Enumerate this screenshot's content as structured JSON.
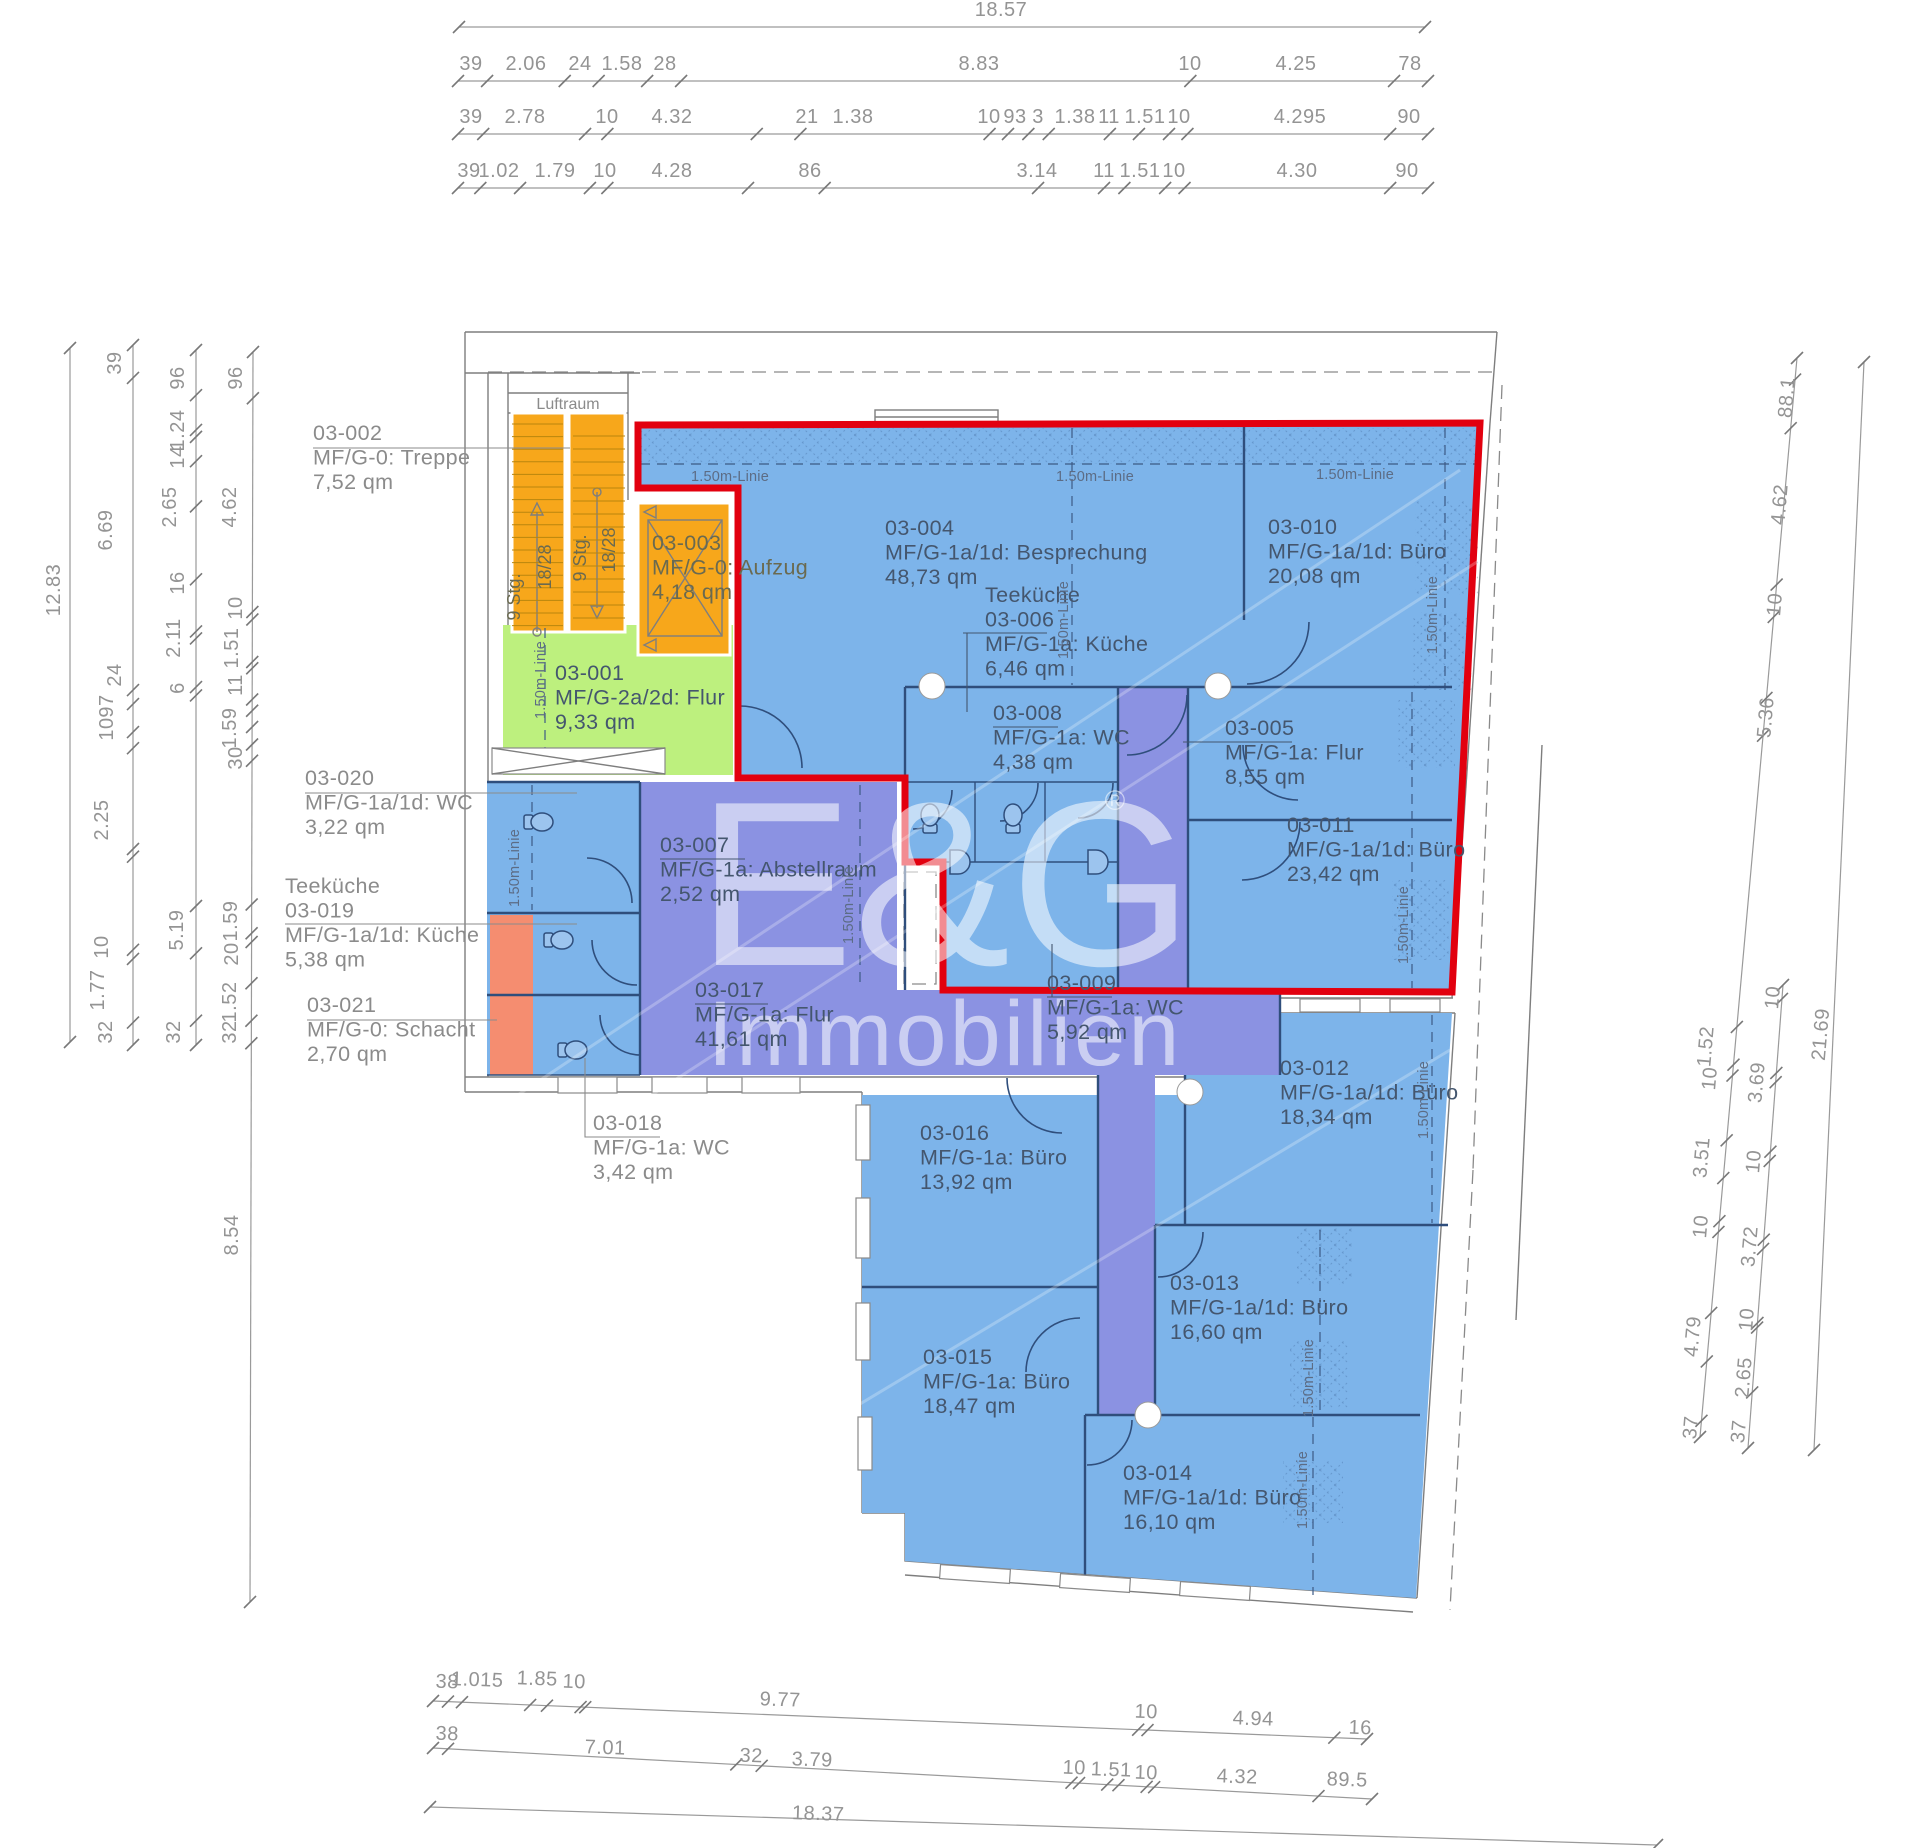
{
  "watermark": {
    "brand": "E&G",
    "reg": "®",
    "word": "Immobilien"
  },
  "static_labels": {
    "luftraum": "Luftraum",
    "linie": "1.50m-Linie",
    "stg": "9 Stg.",
    "risers": "18/28"
  },
  "rooms": [
    {
      "x": 313,
      "y": 440,
      "cls": "o",
      "lines": [
        "03-002",
        "MF/G-0: Treppe",
        "7,52 qm"
      ]
    },
    {
      "x": 305,
      "y": 785,
      "cls": "o",
      "lines": [
        "03-020",
        "MF/G-1a/1d: WC",
        "3,22 qm"
      ]
    },
    {
      "x": 285,
      "y": 893,
      "cls": "o",
      "lines": [
        "Teeküche",
        "03-019",
        "MF/G-1a/1d: Küche",
        "5,38 qm"
      ]
    },
    {
      "x": 307,
      "y": 1012,
      "cls": "o",
      "lines": [
        "03-021",
        "MF/G-0: Schacht",
        "2,70 qm"
      ]
    },
    {
      "x": 593,
      "y": 1130,
      "cls": "o",
      "lines": [
        "03-018",
        "MF/G-1a: WC",
        "3,42 qm"
      ]
    },
    {
      "x": 652,
      "y": 550,
      "cls": "e",
      "lines": [
        "03-003",
        "MF/G-0: Aufzug",
        "4,18 qm"
      ]
    },
    {
      "x": 555,
      "y": 680,
      "cls": "p",
      "lines": [
        "03-001",
        "MF/G-2a/2d: Flur",
        "9,33 qm"
      ]
    },
    {
      "x": 885,
      "y": 535,
      "cls": "p",
      "lines": [
        "03-004",
        "MF/G-1a/1d: Besprechung",
        "48,73 qm"
      ]
    },
    {
      "x": 985,
      "y": 602,
      "cls": "p",
      "lines": [
        "Teeküche",
        "03-006",
        "MF/G-1a: Küche",
        "6,46 qm"
      ]
    },
    {
      "x": 993,
      "y": 720,
      "cls": "p",
      "lines": [
        "03-008",
        "MF/G-1a: WC",
        "4,38 qm"
      ]
    },
    {
      "x": 1268,
      "y": 534,
      "cls": "p",
      "lines": [
        "03-010",
        "MF/G-1a/1d: Büro",
        "20,08 qm"
      ]
    },
    {
      "x": 1225,
      "y": 735,
      "cls": "p",
      "lines": [
        "03-005",
        "MF/G-1a: Flur",
        "8,55 qm"
      ]
    },
    {
      "x": 1287,
      "y": 832,
      "cls": "p",
      "lines": [
        "03-011",
        "MF/G-1a/1d: Büro",
        "23,42 qm"
      ]
    },
    {
      "x": 660,
      "y": 852,
      "cls": "p",
      "lines": [
        "03-007",
        "MF/G-1a: Abstellraum",
        "2,52 qm"
      ]
    },
    {
      "x": 1047,
      "y": 990,
      "cls": "p",
      "lines": [
        "03-009",
        "MF/G-1a: WC",
        "5,92 qm"
      ]
    },
    {
      "x": 695,
      "y": 997,
      "cls": "p",
      "lines": [
        "03-017",
        "MF/G-1a: Flur",
        "41,61 qm"
      ]
    },
    {
      "x": 920,
      "y": 1140,
      "cls": "p",
      "lines": [
        "03-016",
        "MF/G-1a: Büro",
        "13,92 qm"
      ]
    },
    {
      "x": 1280,
      "y": 1075,
      "cls": "p",
      "lines": [
        "03-012",
        "MF/G-1a/1d: Büro",
        "18,34 qm"
      ]
    },
    {
      "x": 1170,
      "y": 1290,
      "cls": "p",
      "lines": [
        "03-013",
        "MF/G-1a/1d: Büro",
        "16,60 qm"
      ]
    },
    {
      "x": 923,
      "y": 1364,
      "cls": "p",
      "lines": [
        "03-015",
        "MF/G-1a: Büro",
        "18,47 qm"
      ]
    },
    {
      "x": 1123,
      "y": 1480,
      "cls": "p",
      "lines": [
        "03-014",
        "MF/G-1a/1d: Büro",
        "16,10 qm"
      ]
    }
  ],
  "dim_labels": [
    {
      "t": "18.57",
      "x": 1001,
      "y": 16
    },
    {
      "t": "39",
      "x": 471,
      "y": 70
    },
    {
      "t": "2.06",
      "x": 526,
      "y": 70
    },
    {
      "t": "24",
      "x": 580,
      "y": 70
    },
    {
      "t": "1.58",
      "x": 622,
      "y": 70
    },
    {
      "t": "28",
      "x": 665,
      "y": 70
    },
    {
      "t": "8.83",
      "x": 979,
      "y": 70
    },
    {
      "t": "10",
      "x": 1190,
      "y": 70
    },
    {
      "t": "4.25",
      "x": 1296,
      "y": 70
    },
    {
      "t": "78",
      "x": 1410,
      "y": 70
    },
    {
      "t": "39",
      "x": 471,
      "y": 123
    },
    {
      "t": "2.78",
      "x": 525,
      "y": 123
    },
    {
      "t": "10",
      "x": 607,
      "y": 123
    },
    {
      "t": "4.32",
      "x": 672,
      "y": 123
    },
    {
      "t": "21",
      "x": 807,
      "y": 123
    },
    {
      "t": "1.38",
      "x": 853,
      "y": 123
    },
    {
      "t": "10",
      "x": 989,
      "y": 123
    },
    {
      "t": "93",
      "x": 1015,
      "y": 123
    },
    {
      "t": "3",
      "x": 1038,
      "y": 123
    },
    {
      "t": "1.38",
      "x": 1075,
      "y": 123
    },
    {
      "t": "11",
      "x": 1109,
      "y": 123
    },
    {
      "t": "1.51",
      "x": 1145,
      "y": 123
    },
    {
      "t": "10",
      "x": 1179,
      "y": 123
    },
    {
      "t": "4.295",
      "x": 1300,
      "y": 123
    },
    {
      "t": "90",
      "x": 1409,
      "y": 123
    },
    {
      "t": "39",
      "x": 469,
      "y": 177
    },
    {
      "t": "1.02",
      "x": 499,
      "y": 177
    },
    {
      "t": "1.79",
      "x": 555,
      "y": 177
    },
    {
      "t": "10",
      "x": 605,
      "y": 177
    },
    {
      "t": "4.28",
      "x": 672,
      "y": 177
    },
    {
      "t": "86",
      "x": 810,
      "y": 177
    },
    {
      "t": "3.14",
      "x": 1037,
      "y": 177
    },
    {
      "t": "11",
      "x": 1104,
      "y": 177
    },
    {
      "t": "1.51",
      "x": 1140,
      "y": 177
    },
    {
      "t": "10",
      "x": 1174,
      "y": 177
    },
    {
      "t": "4.30",
      "x": 1297,
      "y": 177
    },
    {
      "t": "90",
      "x": 1407,
      "y": 177
    },
    {
      "t": "12.83",
      "x": 60,
      "y": 590,
      "r": -90
    },
    {
      "t": "39",
      "x": 121,
      "y": 363,
      "r": -90
    },
    {
      "t": "6.69",
      "x": 112,
      "y": 530,
      "r": -90
    },
    {
      "t": "24",
      "x": 121,
      "y": 675,
      "r": -90
    },
    {
      "t": "97",
      "x": 113,
      "y": 706,
      "r": -90
    },
    {
      "t": "10",
      "x": 113,
      "y": 729,
      "r": -90
    },
    {
      "t": "2.25",
      "x": 108,
      "y": 820,
      "r": -90
    },
    {
      "t": "10",
      "x": 108,
      "y": 947,
      "r": -90
    },
    {
      "t": "1.77",
      "x": 104,
      "y": 990,
      "r": -90
    },
    {
      "t": "32",
      "x": 112,
      "y": 1032,
      "r": -90
    },
    {
      "t": "96",
      "x": 184,
      "y": 378,
      "r": -90
    },
    {
      "t": "1.24",
      "x": 184,
      "y": 430,
      "r": -90
    },
    {
      "t": "14",
      "x": 184,
      "y": 457,
      "r": -90
    },
    {
      "t": "2.65",
      "x": 176,
      "y": 507,
      "r": -90
    },
    {
      "t": "16",
      "x": 184,
      "y": 583,
      "r": -90
    },
    {
      "t": "2.11",
      "x": 180,
      "y": 638,
      "r": -90
    },
    {
      "t": "6",
      "x": 184,
      "y": 688,
      "r": -90
    },
    {
      "t": "5.19",
      "x": 183,
      "y": 930,
      "r": -90
    },
    {
      "t": "32",
      "x": 180,
      "y": 1032,
      "r": -90
    },
    {
      "t": "96",
      "x": 242,
      "y": 378,
      "r": -90
    },
    {
      "t": "4.62",
      "x": 236,
      "y": 507,
      "r": -90
    },
    {
      "t": "10",
      "x": 242,
      "y": 608,
      "r": -90
    },
    {
      "t": "1.51",
      "x": 238,
      "y": 648,
      "r": -90
    },
    {
      "t": "11",
      "x": 242,
      "y": 685,
      "r": -90
    },
    {
      "t": "1.59",
      "x": 236,
      "y": 728,
      "r": -90
    },
    {
      "t": "30",
      "x": 242,
      "y": 758,
      "r": -90
    },
    {
      "t": "1.59",
      "x": 237,
      "y": 921,
      "r": -90
    },
    {
      "t": "20",
      "x": 238,
      "y": 954,
      "r": -90
    },
    {
      "t": "1.52",
      "x": 236,
      "y": 1002,
      "r": -90
    },
    {
      "t": "32",
      "x": 236,
      "y": 1032,
      "r": -90
    },
    {
      "t": "8.54",
      "x": 238,
      "y": 1235,
      "r": -90
    },
    {
      "t": "88.1",
      "x": 1793,
      "y": 398,
      "r": -85
    },
    {
      "t": "4.62",
      "x": 1786,
      "y": 505,
      "r": -85
    },
    {
      "t": "10",
      "x": 1781,
      "y": 605,
      "r": -85
    },
    {
      "t": "5.36",
      "x": 1772,
      "y": 718,
      "r": -85
    },
    {
      "t": "1.52",
      "x": 1712,
      "y": 1047,
      "r": -85
    },
    {
      "t": "10",
      "x": 1716,
      "y": 1079,
      "r": -85
    },
    {
      "t": "3.51",
      "x": 1708,
      "y": 1158,
      "r": -85
    },
    {
      "t": "10",
      "x": 1707,
      "y": 1227,
      "r": -85
    },
    {
      "t": "4.79",
      "x": 1699,
      "y": 1337,
      "r": -85
    },
    {
      "t": "37",
      "x": 1697,
      "y": 1428,
      "r": -85
    },
    {
      "t": "10",
      "x": 1779,
      "y": 998,
      "r": -85
    },
    {
      "t": "3.69",
      "x": 1763,
      "y": 1083,
      "r": -85
    },
    {
      "t": "10",
      "x": 1760,
      "y": 1162,
      "r": -85
    },
    {
      "t": "3.72",
      "x": 1756,
      "y": 1247,
      "r": -85
    },
    {
      "t": "10",
      "x": 1753,
      "y": 1320,
      "r": -85
    },
    {
      "t": "2.65",
      "x": 1750,
      "y": 1378,
      "r": -85
    },
    {
      "t": "37",
      "x": 1745,
      "y": 1432,
      "r": -85
    },
    {
      "t": "21.69",
      "x": 1827,
      "y": 1035,
      "r": -85
    },
    {
      "t": "38",
      "x": 447,
      "y": 1688,
      "r": 2
    },
    {
      "t": "1.015",
      "x": 477,
      "y": 1686,
      "r": 2
    },
    {
      "t": "1.85",
      "x": 537,
      "y": 1685,
      "r": 2
    },
    {
      "t": "10",
      "x": 574,
      "y": 1688,
      "r": 2
    },
    {
      "t": "9.77",
      "x": 780,
      "y": 1706,
      "r": 2
    },
    {
      "t": "10",
      "x": 1146,
      "y": 1718,
      "r": 2
    },
    {
      "t": "4.94",
      "x": 1253,
      "y": 1725,
      "r": 2
    },
    {
      "t": "16",
      "x": 1360,
      "y": 1734,
      "r": 2
    },
    {
      "t": "38",
      "x": 447,
      "y": 1740,
      "r": 2
    },
    {
      "t": "7.01",
      "x": 605,
      "y": 1754,
      "r": 2
    },
    {
      "t": "32",
      "x": 751,
      "y": 1762,
      "r": 2
    },
    {
      "t": "3.79",
      "x": 812,
      "y": 1766,
      "r": 2
    },
    {
      "t": "10",
      "x": 1074,
      "y": 1774,
      "r": 2
    },
    {
      "t": "1.51",
      "x": 1111,
      "y": 1776,
      "r": 2
    },
    {
      "t": "10",
      "x": 1146,
      "y": 1779,
      "r": 2
    },
    {
      "t": "4.32",
      "x": 1237,
      "y": 1783,
      "r": 2
    },
    {
      "t": "89.5",
      "x": 1347,
      "y": 1786,
      "r": 2
    },
    {
      "t": "18.37",
      "x": 818,
      "y": 1820,
      "r": 2
    }
  ],
  "chains": [
    {
      "x1": 459,
      "y1": 27,
      "x2": 1425,
      "y2": 27,
      "t": [
        0,
        1
      ]
    },
    {
      "x1": 458,
      "y1": 81,
      "x2": 1428,
      "y2": 81,
      "t": [
        0,
        0.03,
        0.11,
        0.145,
        0.195,
        0.23,
        0.755,
        0.965,
        1
      ]
    },
    {
      "x1": 458,
      "y1": 134,
      "x2": 1428,
      "y2": 134,
      "t": [
        0,
        0.026,
        0.131,
        0.154,
        0.308,
        0.353,
        0.548,
        0.567,
        0.588,
        0.609,
        0.672,
        0.702,
        0.733,
        0.752,
        0.961,
        1
      ]
    },
    {
      "x1": 458,
      "y1": 188,
      "x2": 1428,
      "y2": 188,
      "t": [
        0,
        0.023,
        0.064,
        0.136,
        0.154,
        0.299,
        0.378,
        0.598,
        0.666,
        0.687,
        0.729,
        0.749,
        0.961,
        1
      ]
    },
    {
      "x1": 70,
      "y1": 348,
      "x2": 70,
      "y2": 1042,
      "t": [
        0,
        1
      ]
    },
    {
      "x1": 133,
      "y1": 345,
      "x2": 133,
      "y2": 1045,
      "t": [
        0,
        0.047,
        0.493,
        0.513,
        0.553,
        0.576,
        0.72,
        0.731,
        0.864,
        0.877,
        0.968,
        1
      ]
    },
    {
      "x1": 196,
      "y1": 350,
      "x2": 196,
      "y2": 1045,
      "t": [
        0,
        0.065,
        0.115,
        0.125,
        0.16,
        0.225,
        0.33,
        0.405,
        0.415,
        0.485,
        0.497,
        0.8,
        0.868,
        0.965,
        1
      ]
    },
    {
      "x1": 253,
      "y1": 352,
      "x2": 250,
      "y2": 1602,
      "t": [
        0,
        0.037,
        0.208,
        0.214,
        0.248,
        0.253,
        0.278,
        0.287,
        0.3,
        0.314,
        0.327,
        0.442,
        0.465,
        0.472,
        0.505,
        0.535,
        0.553,
        1
      ]
    },
    {
      "x1": 1797,
      "y1": 358,
      "x2": 1700,
      "y2": 1437,
      "t": [
        0,
        0.02,
        0.065,
        0.21,
        0.24,
        0.315,
        0.35,
        0.62,
        0.655,
        0.665,
        0.725,
        0.76,
        0.8,
        0.81,
        0.885,
        0.93,
        0.985,
        1
      ]
    },
    {
      "x1": 1783,
      "y1": 985,
      "x2": 1748,
      "y2": 1448,
      "t": [
        0,
        0.03,
        0.19,
        0.21,
        0.36,
        0.38,
        0.55,
        0.57,
        0.73,
        0.74,
        0.88,
        1
      ]
    },
    {
      "x1": 1864,
      "y1": 362,
      "x2": 1814,
      "y2": 1450,
      "t": [
        0,
        1
      ]
    },
    {
      "x1": 433,
      "y1": 1701,
      "x2": 1367,
      "y2": 1739,
      "t": [
        0,
        0.016,
        0.031,
        0.104,
        0.122,
        0.158,
        0.163,
        0.755,
        0.765,
        0.965,
        1
      ]
    },
    {
      "x1": 433,
      "y1": 1748,
      "x2": 1372,
      "y2": 1799,
      "t": [
        0,
        0.016,
        0.323,
        0.35,
        0.68,
        0.688,
        0.718,
        0.73,
        0.76,
        0.768,
        0.943,
        1
      ]
    },
    {
      "x1": 430,
      "y1": 1807,
      "x2": 1657,
      "y2": 1845,
      "t": [
        0,
        1
      ]
    }
  ],
  "linie_labels": [
    {
      "x": 730,
      "y": 481,
      "r": 0
    },
    {
      "x": 1095,
      "y": 481,
      "r": 0
    },
    {
      "x": 1355,
      "y": 479,
      "r": 0
    },
    {
      "x": 545,
      "y": 680,
      "r": -90
    },
    {
      "x": 519,
      "y": 868,
      "r": -90
    },
    {
      "x": 853,
      "y": 905,
      "r": -90
    },
    {
      "x": 1068,
      "y": 620,
      "r": -90
    },
    {
      "x": 1437,
      "y": 615,
      "r": -90
    },
    {
      "x": 1408,
      "y": 925,
      "r": -90
    },
    {
      "x": 1428,
      "y": 1100,
      "r": -90
    },
    {
      "x": 1313,
      "y": 1378,
      "r": -90
    },
    {
      "x": 1307,
      "y": 1490,
      "r": -90
    }
  ],
  "stair_labels": [
    {
      "k": "stg",
      "x": 520,
      "y": 597
    },
    {
      "k": "risers",
      "x": 551,
      "y": 567
    },
    {
      "k": "stg",
      "x": 586,
      "y": 558
    },
    {
      "k": "risers",
      "x": 615,
      "y": 550
    }
  ]
}
